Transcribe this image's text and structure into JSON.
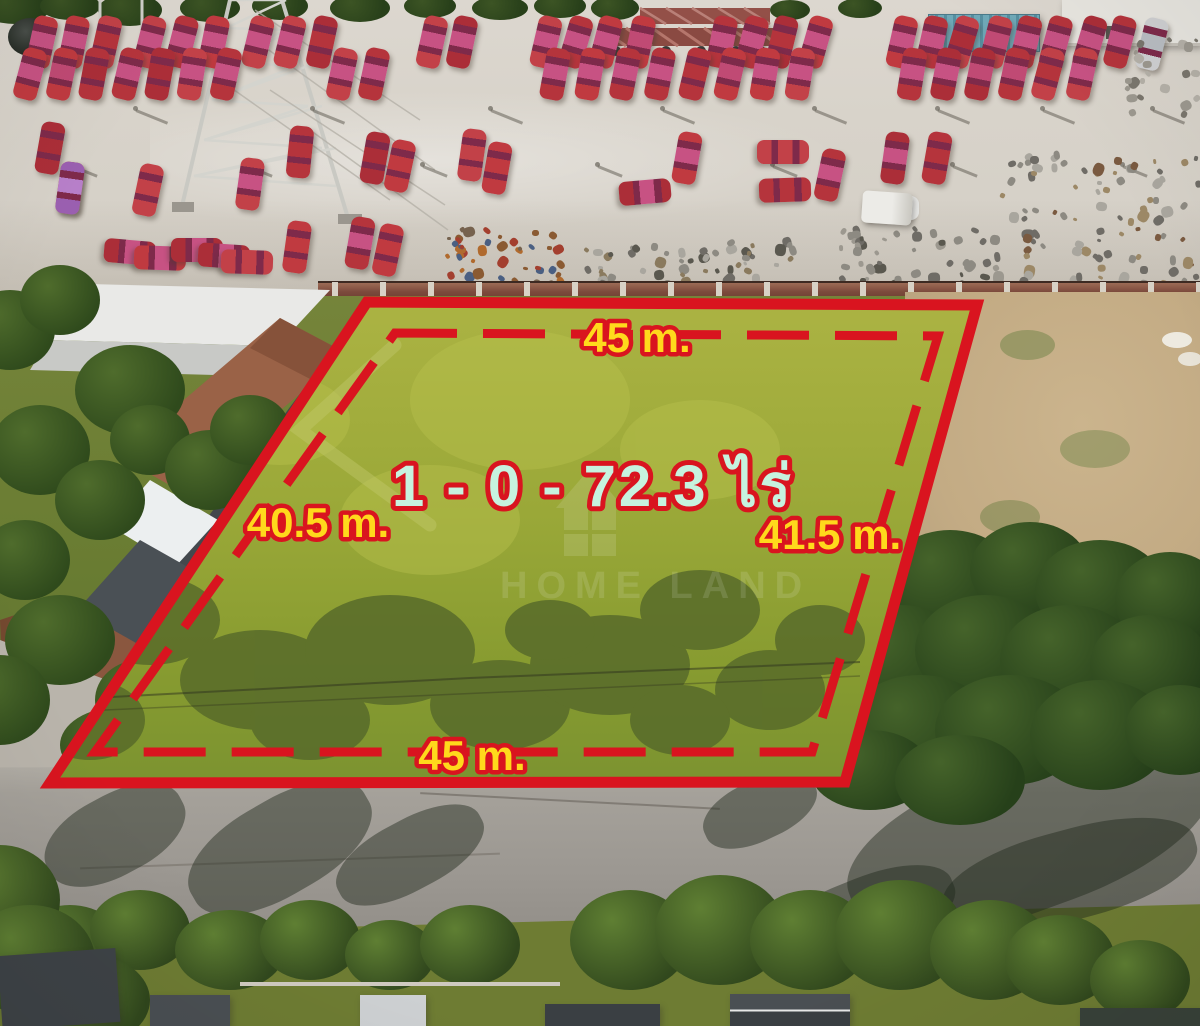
{
  "labels": {
    "area": "1 - 0 - 72.3 ไร่",
    "top": "45 m.",
    "left": "40.5 m.",
    "right": "41.5 m.",
    "bottom": "45 m.",
    "watermark": "HOME LAND"
  },
  "colors": {
    "boundary_red": "#d9141f",
    "label_yellow": "#ffd91c",
    "area_mint": "#c6f2df",
    "concrete": "#d8d3ca",
    "road": "#a19d97",
    "wall_brick": "#7c4a3c",
    "dry_field": "#c3ab84",
    "plot_top": "#adb444",
    "plot_bottom": "#7a9230",
    "glass_dark": "#7e2a4a"
  },
  "plot": {
    "outer_points": "367,302 977,305 845,782 50,783",
    "inner_points": "395,333 938,336 812,752 95,752"
  },
  "cars": {
    "w": 24,
    "h": 52,
    "body_colors": [
      "#b5343c",
      "#c03a40",
      "#ab2e38",
      "#c24148"
    ],
    "roof_colors": [
      "#c75283",
      "#b5343c",
      "#c04a74",
      "#ab2e38"
    ],
    "rows": [
      {
        "y": 42,
        "rot": 14,
        "xs": [
          42,
          74,
          106,
          150,
          182,
          214,
          258,
          290,
          322,
          432,
          462,
          546,
          576,
          606,
          640,
          722,
          752,
          782,
          816,
          902,
          932,
          962,
          996,
          1026,
          1056,
          1090,
          1120
        ]
      },
      {
        "y": 74,
        "rot": 12,
        "xs": [
          30,
          62,
          94,
          128,
          160,
          192,
          226,
          342,
          374,
          555,
          590,
          625,
          660,
          695,
          730,
          765,
          800,
          912,
          946,
          980,
          1014,
          1048,
          1082
        ]
      }
    ],
    "scattered": [
      [
        50,
        148,
        10
      ],
      [
        70,
        188,
        8
      ],
      [
        148,
        190,
        12
      ],
      [
        250,
        184,
        8
      ],
      [
        300,
        152,
        6
      ],
      [
        375,
        158,
        10
      ],
      [
        400,
        166,
        12
      ],
      [
        472,
        155,
        8
      ],
      [
        497,
        168,
        10
      ],
      [
        645,
        192,
        85
      ],
      [
        687,
        158,
        10
      ],
      [
        783,
        152,
        90
      ],
      [
        785,
        190,
        88
      ],
      [
        830,
        175,
        12
      ],
      [
        895,
        158,
        8
      ],
      [
        937,
        158,
        10
      ],
      [
        130,
        252,
        95
      ],
      [
        160,
        258,
        92
      ],
      [
        197,
        250,
        90
      ],
      [
        224,
        256,
        94
      ],
      [
        247,
        262,
        92
      ],
      [
        297,
        247,
        8
      ],
      [
        360,
        243,
        10
      ],
      [
        388,
        250,
        12
      ]
    ],
    "special": [
      {
        "x": 1152,
        "y": 44,
        "rot": 14,
        "body": "#cfd0d2",
        "roof": "#b9bdc2",
        "name": "silver-car"
      },
      {
        "x": 70,
        "y": 188,
        "rot": 8,
        "body": "#9a5fb0",
        "roof": "#b77fc9",
        "name": "purple-taxi"
      },
      {
        "x": 893,
        "y": 208,
        "rot": 90,
        "body": "#e7e7e5",
        "roof": "#b9bdc2",
        "name": "white-van"
      },
      {
        "x": 832,
        "y": 806,
        "rot": 97,
        "body": "#f1f1ee",
        "roof": "#8e9298",
        "name": "white-car-on-road"
      }
    ]
  },
  "poles": {
    "rows": [
      {
        "y": 106,
        "xs": [
          133,
          310,
          488,
          660,
          812,
          935,
          1040,
          1150
        ],
        "len": 34
      },
      {
        "y": 162,
        "xs": [
          70,
          245,
          420,
          595,
          770,
          950,
          1120
        ],
        "len": 26
      }
    ]
  },
  "scrap_clusters": [
    {
      "x": 445,
      "y": 226,
      "w": 115,
      "h": 58,
      "n": 46,
      "colors": [
        "#b06a2e",
        "#8a5a32",
        "#4a5f82",
        "#a33f2f",
        "#76624e"
      ]
    },
    {
      "x": 578,
      "y": 238,
      "w": 215,
      "h": 48,
      "n": 60,
      "colors": [
        "#8d8a82",
        "#6f6c66",
        "#a9a69e",
        "#5a584f",
        "#8a7a5e"
      ]
    },
    {
      "x": 835,
      "y": 226,
      "w": 160,
      "h": 60,
      "n": 48,
      "colors": [
        "#8d8a82",
        "#5a584f",
        "#9c988f",
        "#6f6c66"
      ]
    },
    {
      "x": 1000,
      "y": 152,
      "w": 195,
      "h": 130,
      "n": 90,
      "colors": [
        "#8d8a82",
        "#9c8866",
        "#6f6c66",
        "#a9a69e",
        "#7a5a40"
      ]
    },
    {
      "x": 1125,
      "y": 38,
      "w": 70,
      "h": 80,
      "n": 22,
      "colors": [
        "#9c988f",
        "#b5b1a8",
        "#7a766d"
      ]
    }
  ],
  "trees": {
    "top_strip": [
      [
        15,
        8,
        35,
        16
      ],
      [
        70,
        6,
        30,
        14
      ],
      [
        130,
        10,
        32,
        16
      ],
      [
        210,
        8,
        30,
        14
      ],
      [
        280,
        6,
        28,
        14
      ],
      [
        360,
        8,
        30,
        14
      ],
      [
        430,
        6,
        26,
        12
      ],
      [
        500,
        8,
        28,
        12
      ],
      [
        560,
        6,
        26,
        12
      ],
      [
        615,
        8,
        24,
        12
      ],
      [
        790,
        10,
        20,
        10
      ],
      [
        860,
        8,
        22,
        10
      ]
    ],
    "left": [
      [
        10,
        330,
        45,
        40
      ],
      [
        60,
        300,
        40,
        35
      ],
      [
        130,
        390,
        55,
        45
      ],
      [
        40,
        450,
        50,
        45
      ],
      [
        100,
        500,
        45,
        40
      ],
      [
        25,
        560,
        45,
        40
      ],
      [
        150,
        440,
        40,
        35
      ],
      [
        210,
        470,
        45,
        40
      ],
      [
        250,
        430,
        40,
        35
      ],
      [
        60,
        640,
        55,
        45
      ],
      [
        0,
        700,
        50,
        45
      ],
      [
        140,
        700,
        45,
        40
      ],
      [
        120,
        745,
        60,
        38
      ],
      [
        230,
        748,
        55,
        34
      ],
      [
        320,
        752,
        50,
        32
      ]
    ],
    "right": [
      [
        880,
        600,
        60,
        50
      ],
      [
        950,
        580,
        65,
        50
      ],
      [
        1030,
        570,
        60,
        48
      ],
      [
        1100,
        590,
        65,
        50
      ],
      [
        1170,
        600,
        55,
        48
      ],
      [
        900,
        660,
        70,
        55
      ],
      [
        985,
        650,
        70,
        55
      ],
      [
        1070,
        660,
        70,
        55
      ],
      [
        1150,
        665,
        60,
        50
      ],
      [
        920,
        730,
        75,
        55
      ],
      [
        1010,
        730,
        75,
        55
      ],
      [
        1100,
        735,
        70,
        55
      ],
      [
        1180,
        730,
        55,
        45
      ],
      [
        870,
        770,
        60,
        40
      ],
      [
        960,
        780,
        65,
        45
      ]
    ],
    "bottom": [
      [
        70,
        950,
        55,
        45
      ],
      [
        140,
        930,
        50,
        40
      ],
      [
        230,
        950,
        55,
        40
      ],
      [
        310,
        940,
        50,
        40
      ],
      [
        390,
        955,
        45,
        35
      ],
      [
        470,
        945,
        50,
        40
      ],
      [
        630,
        940,
        60,
        50
      ],
      [
        720,
        930,
        65,
        55
      ],
      [
        810,
        940,
        60,
        50
      ],
      [
        900,
        935,
        65,
        55
      ],
      [
        990,
        950,
        60,
        50
      ],
      [
        1060,
        960,
        55,
        45
      ],
      [
        1140,
        980,
        50,
        40
      ],
      [
        0,
        900,
        60,
        55
      ],
      [
        30,
        960,
        65,
        55
      ],
      [
        90,
        1000,
        60,
        45
      ]
    ]
  },
  "road_shadows": [
    [
      40,
      795,
      150,
      80,
      -28
    ],
    [
      180,
      800,
      200,
      95,
      -30
    ],
    [
      330,
      820,
      160,
      70,
      -28
    ],
    [
      700,
      780,
      120,
      60,
      -25
    ],
    [
      840,
      760,
      380,
      150,
      -20
    ],
    [
      940,
      830,
      260,
      90,
      -15
    ],
    [
      600,
      900,
      150,
      60,
      -25
    ],
    [
      760,
      880,
      200,
      80,
      -22
    ]
  ],
  "plot_texture": {
    "dark_blobs": [
      [
        150,
        620,
        70,
        45
      ],
      [
        260,
        680,
        80,
        50
      ],
      [
        390,
        650,
        85,
        55
      ],
      [
        500,
        705,
        70,
        45
      ],
      [
        610,
        665,
        80,
        50
      ],
      [
        700,
        610,
        60,
        40
      ],
      [
        770,
        690,
        55,
        40
      ],
      [
        820,
        640,
        45,
        35
      ],
      [
        310,
        720,
        60,
        40
      ],
      [
        90,
        720,
        55,
        40
      ],
      [
        550,
        630,
        45,
        30
      ],
      [
        680,
        720,
        50,
        35
      ]
    ],
    "light_blobs": [
      [
        520,
        400,
        110,
        70
      ],
      [
        700,
        450,
        80,
        50
      ],
      [
        280,
        420,
        70,
        45
      ],
      [
        430,
        520,
        90,
        55
      ]
    ]
  }
}
